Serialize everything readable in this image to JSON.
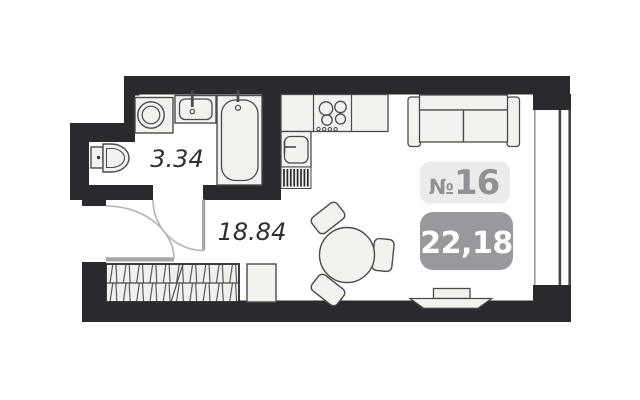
{
  "floor_plan": {
    "unit": {
      "prefix": "№",
      "number": "16"
    },
    "total_area": "22,18",
    "rooms": [
      {
        "name": "bathroom",
        "area": "3.34"
      },
      {
        "name": "living-room-studio",
        "area": "18.84"
      }
    ],
    "fixtures": [
      "washing-machine",
      "bathroom-sink",
      "bathtub",
      "toilet",
      "kitchen-counter",
      "stove",
      "kitchen-sink",
      "kitchen-vent-grille",
      "sofa",
      "dining-table",
      "chairs",
      "wardrobe",
      "nightstand",
      "radiator",
      "window",
      "entrance-door",
      "bathroom-door"
    ],
    "colors": {
      "wall": "#2a2a2e",
      "fixture_fill": "#f2f2ee",
      "fixture_stroke": "#4b4b4f",
      "door_swing": "#b5b5b5",
      "door_leaf": "#a5a5a5",
      "window_line": "#44444a",
      "sill_line": "#9a9a9a",
      "badge_light_bg": "#ebebec",
      "badge_gray_bg": "#98989d",
      "badge_text_gray": "#909095",
      "badge_text_white": "#ffffff",
      "label_text": "#2e2e33"
    }
  }
}
